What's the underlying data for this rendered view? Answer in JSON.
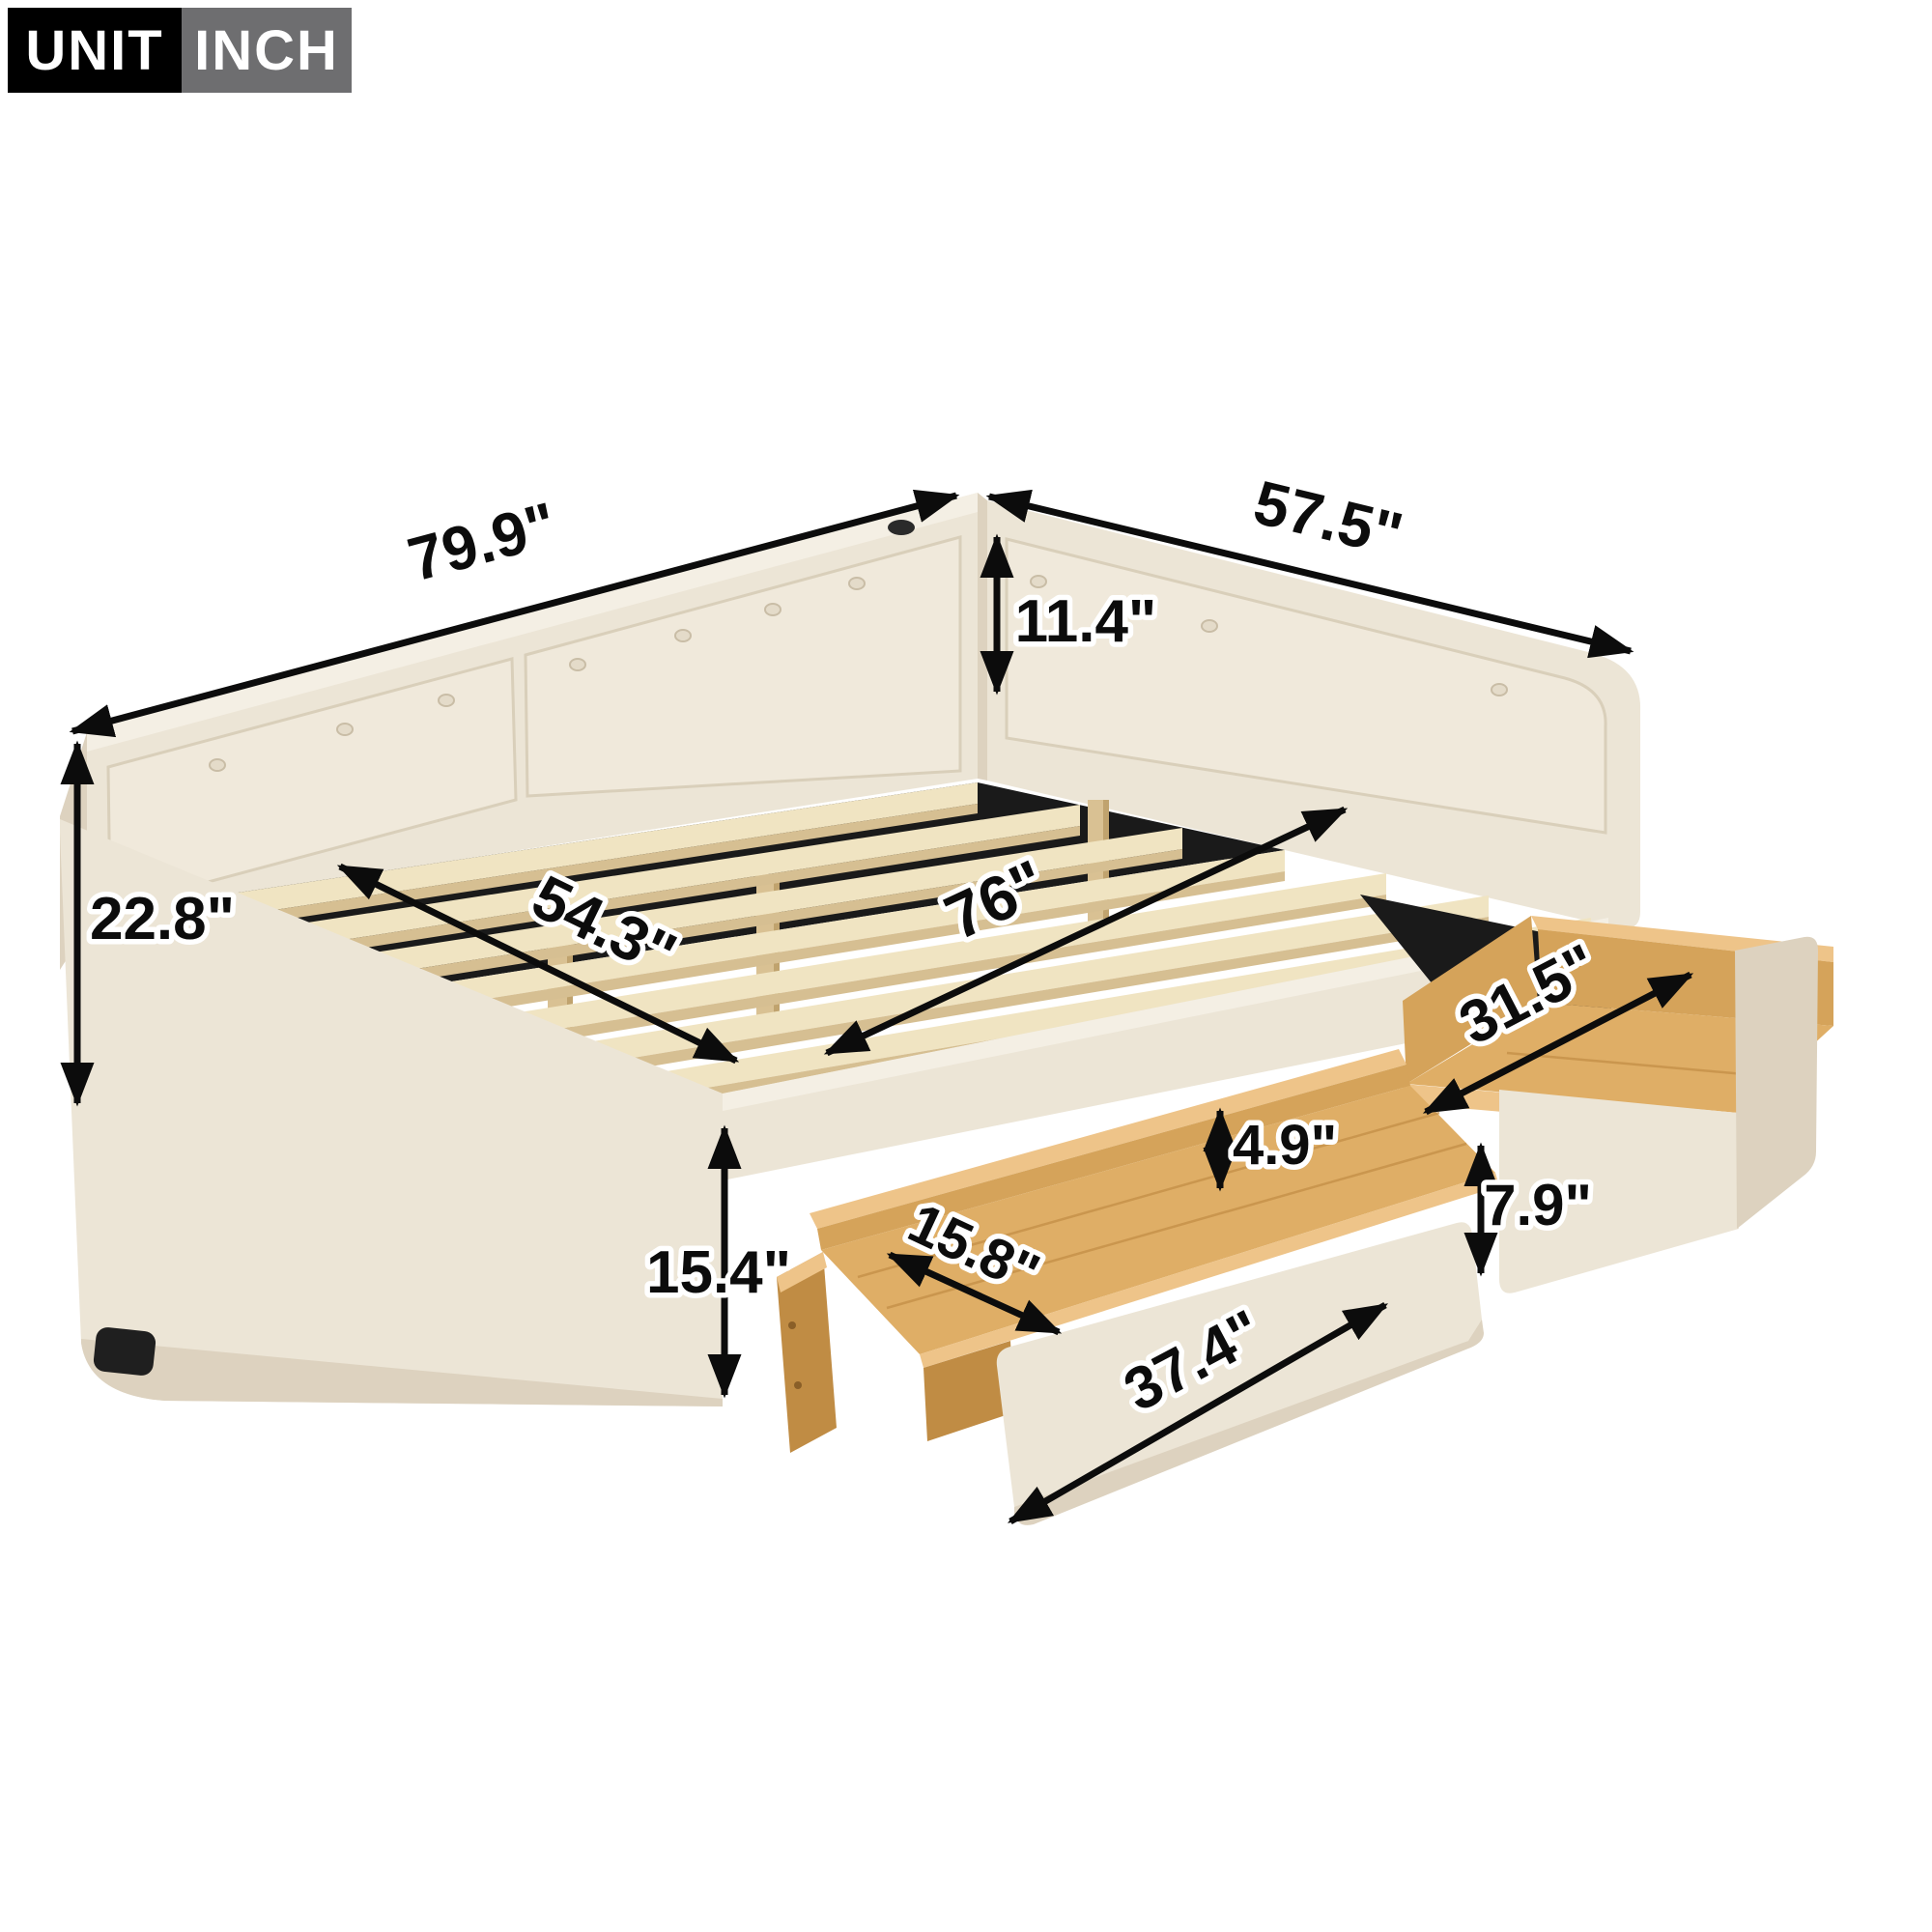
{
  "page": {
    "background": "#ffffff",
    "description": "Product dimension diagram of an upholstered daybed with wooden slats and two pull-out storage drawers"
  },
  "unit_badge": {
    "unit_label": "UNIT",
    "inch_label": "INCH"
  },
  "theme": {
    "upholstery": "#ece5d6",
    "upholstery_light": "#f4efe4",
    "upholstery_dark": "#ddd2bf",
    "cushion": "#f0e9db",
    "piping": "#d9cfba",
    "wood_slat": "#f0e4c2",
    "wood_slat_edge": "#d6bf92",
    "wood_post": "#d9c193",
    "wood_post_shadow": "#c0a36e",
    "drawer_wood": "#dfae66",
    "drawer_wood_light": "#eec489",
    "drawer_wood_mid": "#d5a35a",
    "drawer_wood_dark": "#c08c44",
    "deck_black": "#1a1a1a",
    "dim_color": "#0c0c0c",
    "badge_unit_bg": "#000000",
    "badge_inch_bg": "#6e6e70"
  },
  "product": {
    "slat_count": 7,
    "drawer_count": 2,
    "back_button_count": 7,
    "arm_button_count": 3
  },
  "dimensions": {
    "total_length": {
      "label": "total length along backrest",
      "value": "79.9\""
    },
    "total_width": {
      "label": "total width along arm",
      "value": "57.5\""
    },
    "backrest_height": {
      "label": "backrest height above deck",
      "value": "11.4\""
    },
    "total_height": {
      "label": "overall height",
      "value": "22.8\""
    },
    "inner_width": {
      "label": "inner slat width",
      "value": "54.3\""
    },
    "inner_length": {
      "label": "inner slat length",
      "value": "76\""
    },
    "drawer_inner_length": {
      "label": "drawer inner length",
      "value": "31.5\""
    },
    "drawer_inner_depth": {
      "label": "drawer inner depth",
      "value": "4.9\""
    },
    "drawer_front_height": {
      "label": "drawer front height",
      "value": "7.9\""
    },
    "drawer_inner_width": {
      "label": "drawer inner width",
      "value": "15.8\""
    },
    "drawer_front_length": {
      "label": "drawer front length",
      "value": "37.4\""
    },
    "side_rail_height": {
      "label": "frame side height",
      "value": "15.4\""
    }
  }
}
